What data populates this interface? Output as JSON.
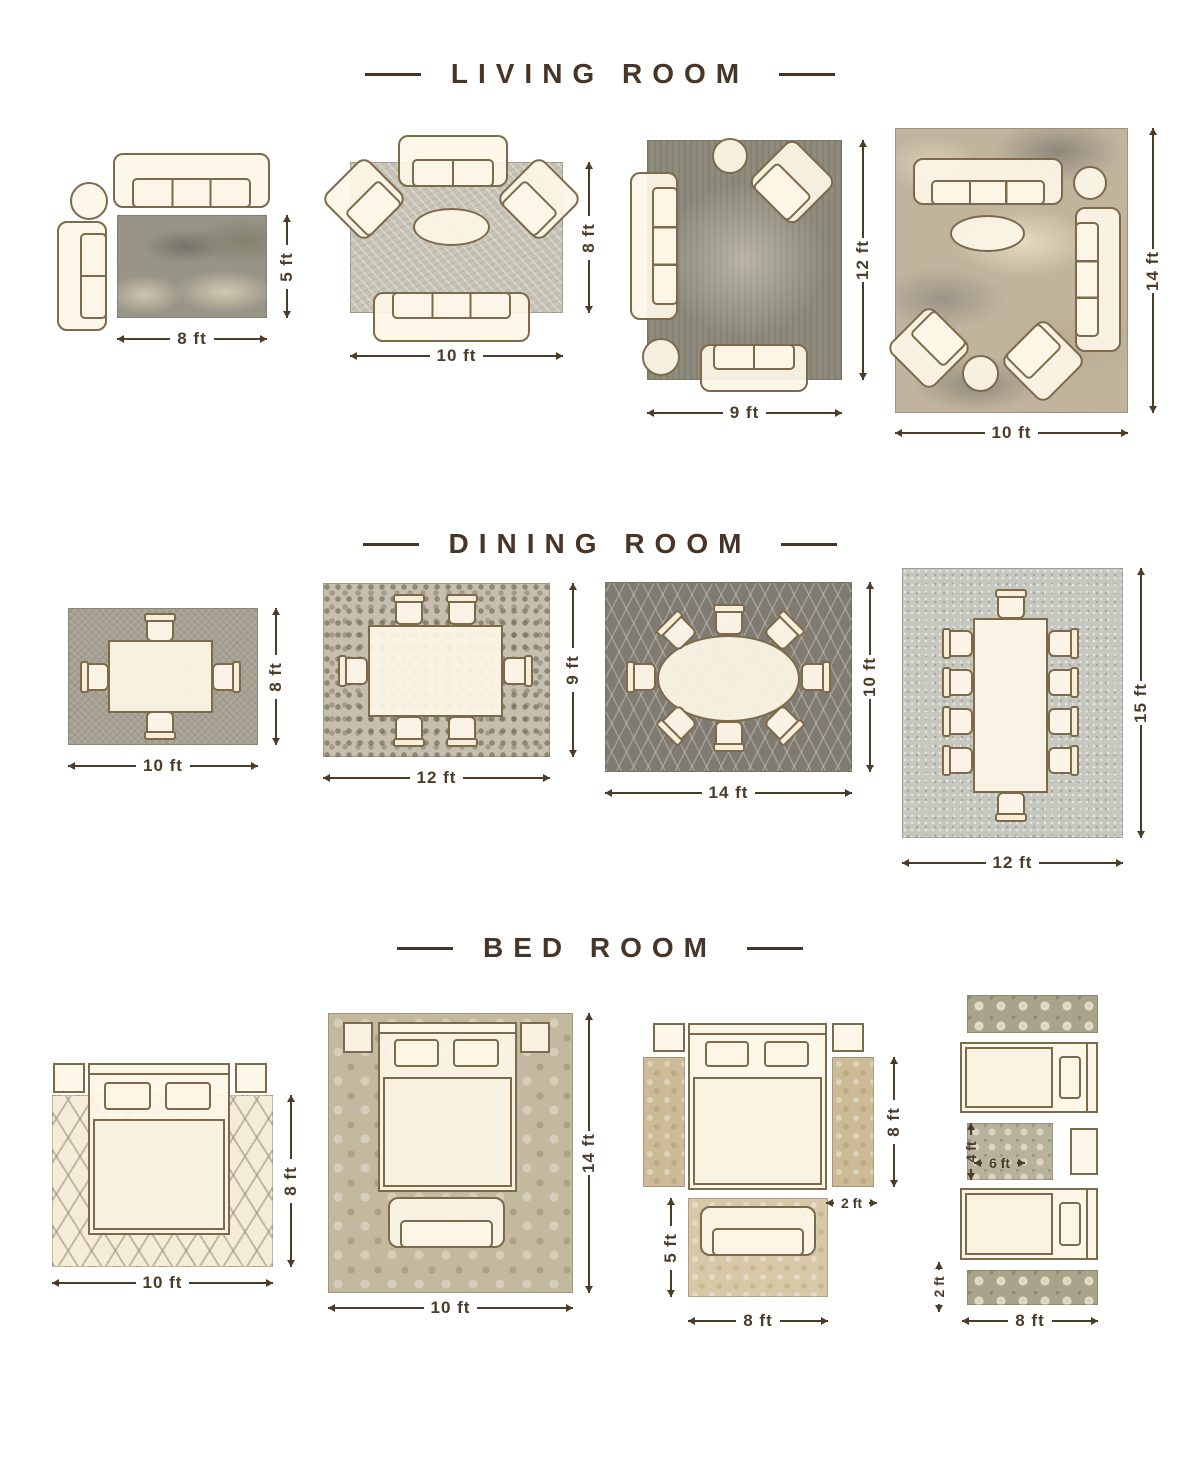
{
  "colors": {
    "accent_text": "#473627",
    "furniture_fill": "#fdf6e7",
    "furniture_outline": "#7d6a4a",
    "background": "#ffffff"
  },
  "sections": [
    {
      "title": "LIVING ROOM",
      "layouts": [
        {
          "width": "8 ft",
          "height": "5 ft"
        },
        {
          "width": "10 ft",
          "height": "8 ft"
        },
        {
          "width": "9 ft",
          "height": "12 ft"
        },
        {
          "width": "10 ft",
          "height": "14 ft"
        }
      ]
    },
    {
      "title": "DINING ROOM",
      "layouts": [
        {
          "width": "10 ft",
          "height": "8 ft"
        },
        {
          "width": "12 ft",
          "height": "9 ft"
        },
        {
          "width": "14 ft",
          "height": "10 ft"
        },
        {
          "width": "12 ft",
          "height": "15 ft"
        }
      ]
    },
    {
      "title": "BED ROOM",
      "layouts": [
        {
          "width": "10 ft",
          "height": "8 ft"
        },
        {
          "width": "10 ft",
          "height": "14 ft"
        },
        {
          "bed_height": "8 ft",
          "runner_width": "2 ft",
          "sofa_rug_height": "5 ft",
          "sofa_rug_width": "8 ft"
        },
        {
          "center_rug_height": "4 ft",
          "center_rug_width": "6 ft",
          "runner_height": "2 ft",
          "beds_width": "8 ft"
        }
      ]
    }
  ]
}
